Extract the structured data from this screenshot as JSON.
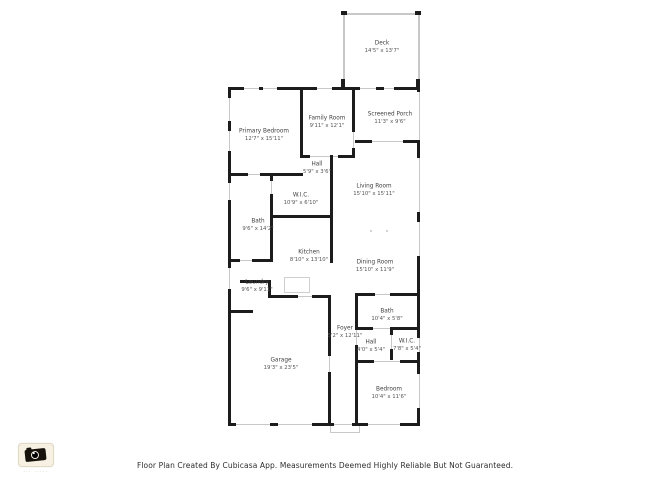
{
  "rooms": {
    "deck": {
      "name": "Deck",
      "dims": "14'5\" x 13'7\""
    },
    "primary_bedroom": {
      "name": "Primary Bedroom",
      "dims": "12'7\" x 15'11\""
    },
    "family_room": {
      "name": "Family Room",
      "dims": "9'11\" x 12'1\""
    },
    "screened_porch": {
      "name": "Screened Porch",
      "dims": "11'3\" x 9'6\""
    },
    "hall_upper": {
      "name": "Hall",
      "dims": "5'9\" x 3'6\""
    },
    "wic_upper": {
      "name": "W.I.C.",
      "dims": "10'9\" x 6'10\""
    },
    "living_room": {
      "name": "Living Room",
      "dims": "15'10\" x 15'11\""
    },
    "bath_upper": {
      "name": "Bath",
      "dims": "9'6\" x 14'2\""
    },
    "kitchen": {
      "name": "Kitchen",
      "dims": "8'10\" x 13'10\""
    },
    "dining_room": {
      "name": "Dining Room",
      "dims": "15'10\" x 11'9\""
    },
    "laundry": {
      "name": "Laundry",
      "dims": "9'6\" x 9'11\""
    },
    "foyer": {
      "name": "Foyer",
      "dims": "5'2\" x 12'11\""
    },
    "bath_lower": {
      "name": "Bath",
      "dims": "10'4\" x 5'8\""
    },
    "hall_lower": {
      "name": "Hall",
      "dims": "4'0\" x 5'4\""
    },
    "wic_lower": {
      "name": "W.I.C.",
      "dims": "7'8\" x 5'4\""
    },
    "garage": {
      "name": "Garage",
      "dims": "19'3\" x 23'5\""
    },
    "bedroom": {
      "name": "Bedroom",
      "dims": "10'4\" x 11'6\""
    }
  },
  "footer": {
    "text": "Floor Plan Created By Cubicasa App. Measurements Deemed Highly Reliable But Not Guaranteed."
  },
  "logo": {
    "caption": "··· ·····"
  },
  "colors": {
    "wall": "#1c1c1c",
    "window": "#c8c8c8",
    "label": "#4a4a4a",
    "footer_text": "#2e2e2e",
    "logo_bg": "#f6f1e2"
  }
}
